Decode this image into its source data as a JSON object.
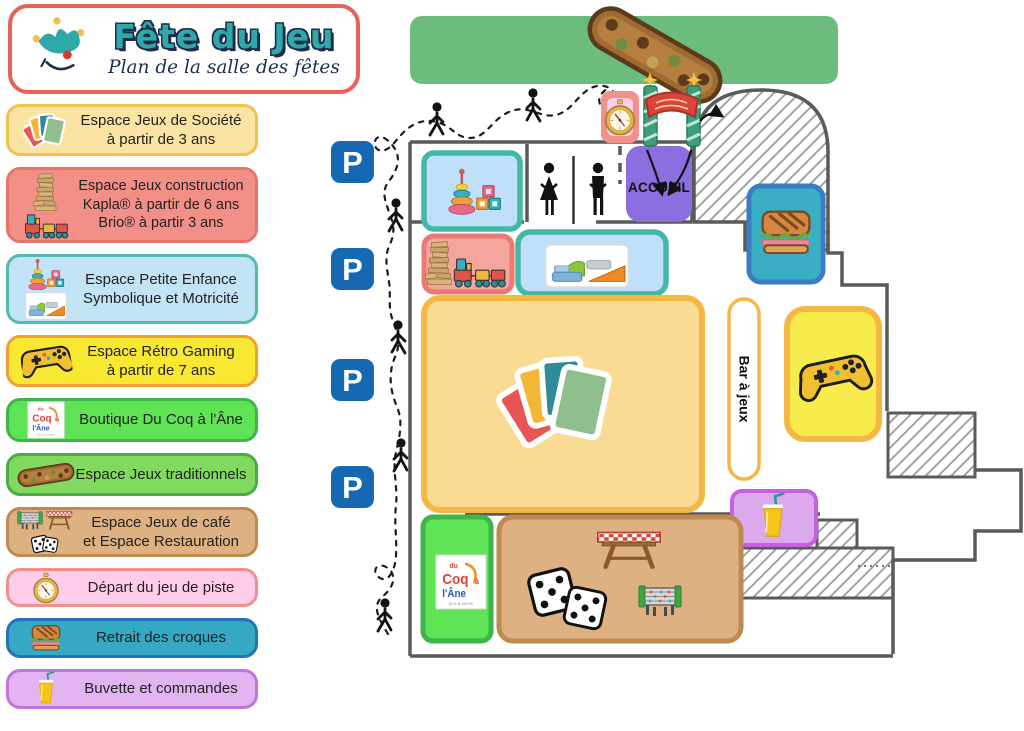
{
  "header": {
    "title": "Fête du Jeu",
    "subtitle": "Plan de la salle des fêtes"
  },
  "legend": {
    "items": [
      {
        "id": "jeux-societe",
        "icon": "cards-icon",
        "bg": "#FBE4A3",
        "border": "#F2C14E",
        "lines": [
          "Espace Jeux de Société",
          "à partir de 3 ans"
        ]
      },
      {
        "id": "jeux-construction",
        "icon": "kapla-and-train-icon",
        "bg": "#F29088",
        "border": "#E8736D",
        "lines": [
          "Espace Jeux construction",
          "Kapla® à partir de 6 ans",
          "Brio® à partir 3 ans"
        ]
      },
      {
        "id": "petite-enfance",
        "icon": "baby-toys-and-mats-icon",
        "bg": "#C3E3F7",
        "border": "#52BCAC",
        "lines": [
          "Espace Petite Enfance",
          "Symbolique et Motricité"
        ]
      },
      {
        "id": "retro-gaming",
        "icon": "gamepad-icon",
        "bg": "#F8E832",
        "border": "#F0A030",
        "lines": [
          "Espace Rétro Gaming",
          "à partir de 7 ans"
        ]
      },
      {
        "id": "boutique",
        "icon": "coq-ane-logo",
        "bg": "#5FE455",
        "border": "#3EB549",
        "lines": [
          "Boutique Du Coq à l'Âne"
        ]
      },
      {
        "id": "jeux-traditionnels",
        "icon": "wooden-game-icon",
        "bg": "#82D95F",
        "border": "#4BAB48",
        "lines": [
          "Espace Jeux traditionnels"
        ]
      },
      {
        "id": "jeux-cafe-restauration",
        "icon": "foosball-picnic-dice-icon",
        "bg": "#DDB181",
        "border": "#BE8A50",
        "lines": [
          "Espace Jeux de café",
          "et Espace Restauration"
        ]
      },
      {
        "id": "jeu-de-piste",
        "icon": "compass-icon",
        "bg": "#FFCDEA",
        "border": "#F2908B",
        "lines": [
          "Départ du jeu de piste"
        ]
      },
      {
        "id": "croques",
        "icon": "croque-icon",
        "bg": "#35A9C4",
        "border": "#2472B8",
        "lines": [
          "Retrait des croques"
        ]
      },
      {
        "id": "buvette",
        "icon": "juice-icon",
        "bg": "#E3B4F2",
        "border": "#C273DE",
        "lines": [
          "Buvette et commandes"
        ]
      }
    ]
  },
  "map": {
    "accueil_label": "ACCUEIL",
    "bar_label": "Bar à jeux",
    "parking_label": "P",
    "coq_logo": {
      "du": "du",
      "coq": "Coq",
      "a": "à",
      "lane": "l'Âne",
      "tagline": "jeux & jouets"
    },
    "colors": {
      "wall": "#5A5A5A",
      "outdoor_green": "#6CBC7E",
      "parking_blue": "#1668B3",
      "accueil_purple": "#8B6FE0",
      "bar_border": "#F5B845"
    }
  },
  "colors": {
    "header_border": "#E8625A",
    "title_teal": "#2FA8A8",
    "title_navy": "#1E2D50"
  }
}
